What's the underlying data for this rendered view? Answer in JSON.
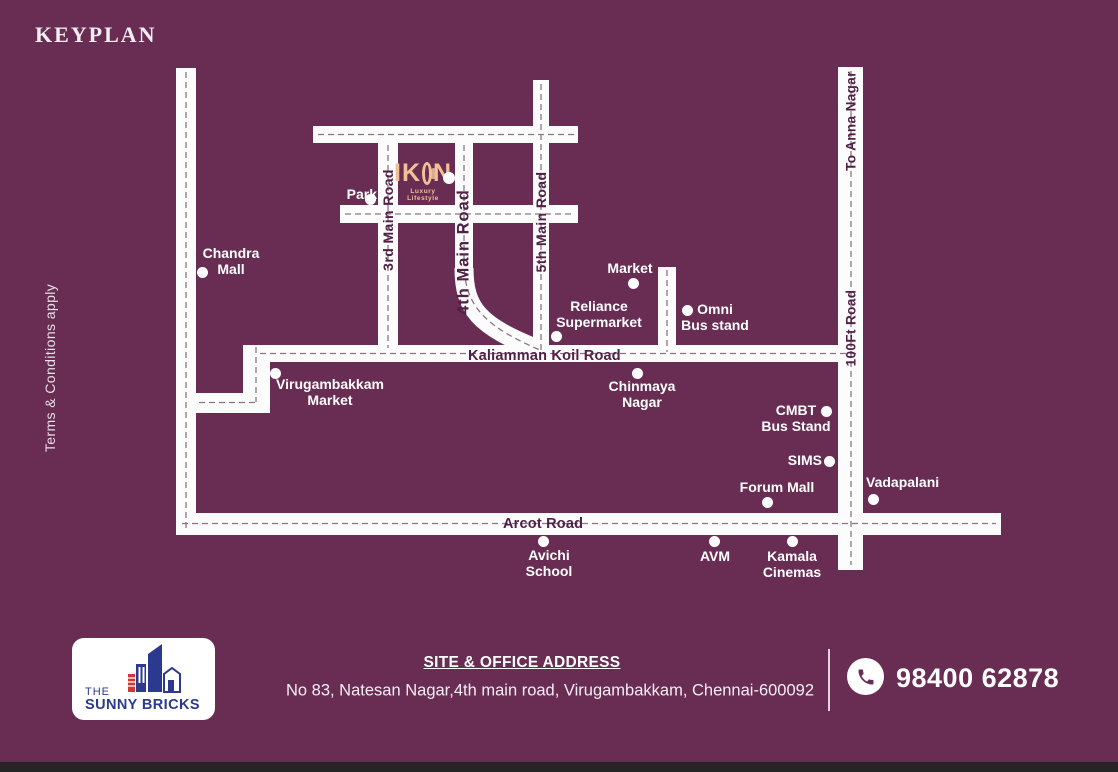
{
  "page": {
    "title": "KEYPLAN",
    "terms": "Terms & Conditions apply"
  },
  "map": {
    "project_logo": {
      "name": "IKON",
      "part1": "IK",
      "part2": "N",
      "tagline": "Luxury Lifestyle"
    },
    "road_labels": [
      {
        "id": "3rd-main-road",
        "label": "3rd Main Road"
      },
      {
        "id": "4th-main-road",
        "label": "4th Main Road"
      },
      {
        "id": "5th-main-road",
        "label": "5th Main Road"
      },
      {
        "id": "to-anna-nagar",
        "label": "To Anna Nagar"
      },
      {
        "id": "100ft-road",
        "label": "100Ft Road"
      },
      {
        "id": "kaliamman-koil-road",
        "label": "Kaliamman Koil Road"
      },
      {
        "id": "arcot-road",
        "label": "Arcot Road"
      }
    ],
    "landmarks": [
      {
        "id": "park",
        "label": "Park"
      },
      {
        "id": "chandra-mall",
        "label": "Chandra\nMall"
      },
      {
        "id": "market",
        "label": "Market"
      },
      {
        "id": "reliance-supermarket",
        "label": "Reliance\nSupermarket"
      },
      {
        "id": "omni-bus-stand",
        "label": "Omni\nBus stand"
      },
      {
        "id": "virugambakkam-market",
        "label": "Virugambakkam\nMarket"
      },
      {
        "id": "chinmaya-nagar",
        "label": "Chinmaya\nNagar"
      },
      {
        "id": "cmbt-bus-stand",
        "label": "CMBT\nBus Stand"
      },
      {
        "id": "sims",
        "label": "SIMS"
      },
      {
        "id": "forum-mall",
        "label": "Forum Mall"
      },
      {
        "id": "vadapalani",
        "label": "Vadapalani"
      },
      {
        "id": "avichi-school",
        "label": "Avichi\nSchool"
      },
      {
        "id": "avm",
        "label": "AVM"
      },
      {
        "id": "kamala-cinemas",
        "label": "Kamala\nCinemas"
      }
    ]
  },
  "footer": {
    "brand": {
      "line1": "THE",
      "line2": "SUNNY BRICKS"
    },
    "address_heading": "SITE & OFFICE ADDRESS",
    "address": "No 83, Natesan Nagar,4th main road, Virugambakkam, Chennai-600092",
    "phone": "98400 62878"
  },
  "colors": {
    "background": "#692c52",
    "road": "#fdfcfd",
    "dash": "#8d7485",
    "road_text": "#4f2145",
    "label_text": "#ffffff",
    "accent_peach": "#f0c198",
    "brand_blue": "#2b3a8f",
    "brand_red": "#cf3833"
  }
}
